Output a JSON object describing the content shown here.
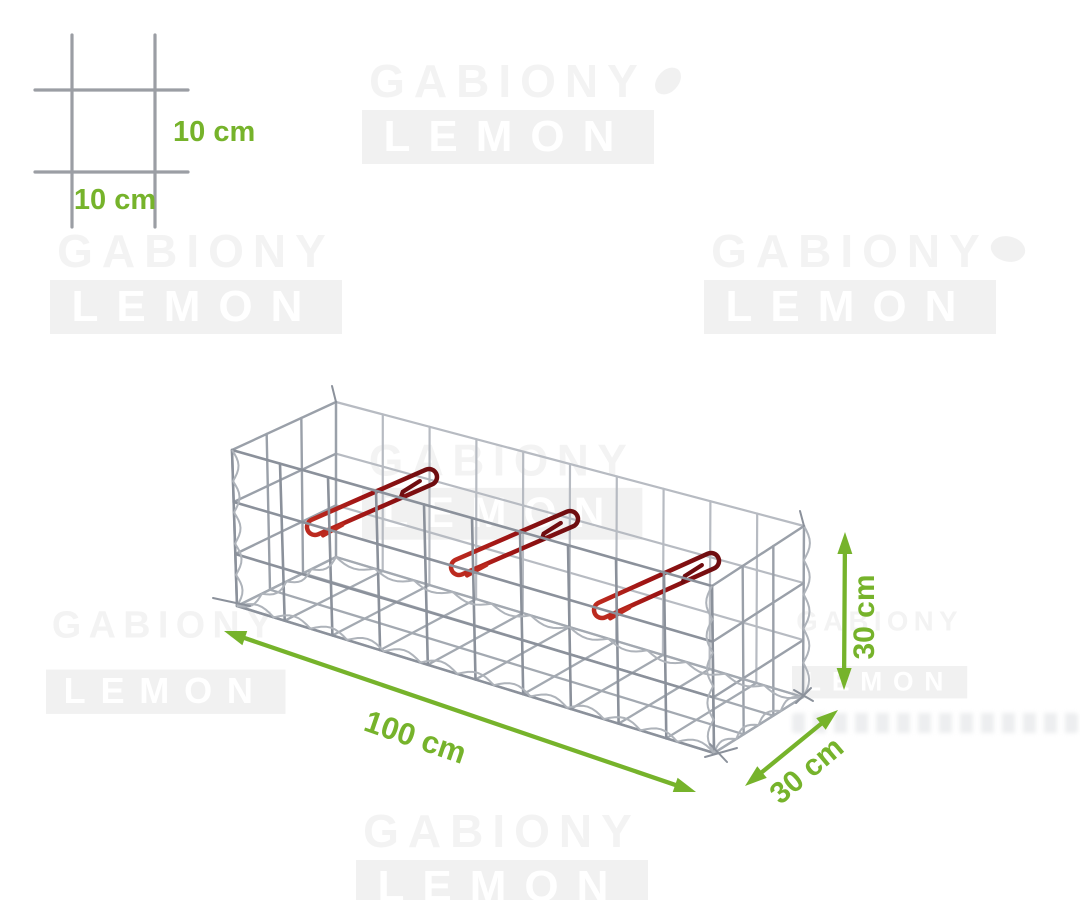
{
  "image_alt": "3D wireframe render of a welded-mesh gabion basket with green dimension arrows and a mesh-size detail sketch",
  "watermark": {
    "line1": "GABIONY",
    "line2": "LEMON"
  },
  "mesh_detail": {
    "vertical_spacing_label": "10 cm",
    "horizontal_spacing_label": "10 cm"
  },
  "dimension_labels": {
    "length": "100 cm",
    "depth": "30 cm",
    "height": "30 cm"
  },
  "product": {
    "length_cm": 100,
    "depth_cm": 30,
    "height_cm": 30,
    "mesh_cell_cm": 10,
    "clip_count": 3
  },
  "colors": {
    "accent_green": "#76b32b",
    "clip_red_dark": "#6f0d10",
    "clip_red": "#9e1414",
    "clip_red_bright": "#bc2a1f",
    "wire_dark": "#8b919b",
    "wire_mid": "#9aa0a9",
    "wire_light": "#b7bbc2",
    "spiral_gray": "#aeb3ba",
    "watermark_text": "#f3f3f3",
    "watermark_block": "#f1f1f1",
    "watermark_inner": "#ffffff"
  }
}
